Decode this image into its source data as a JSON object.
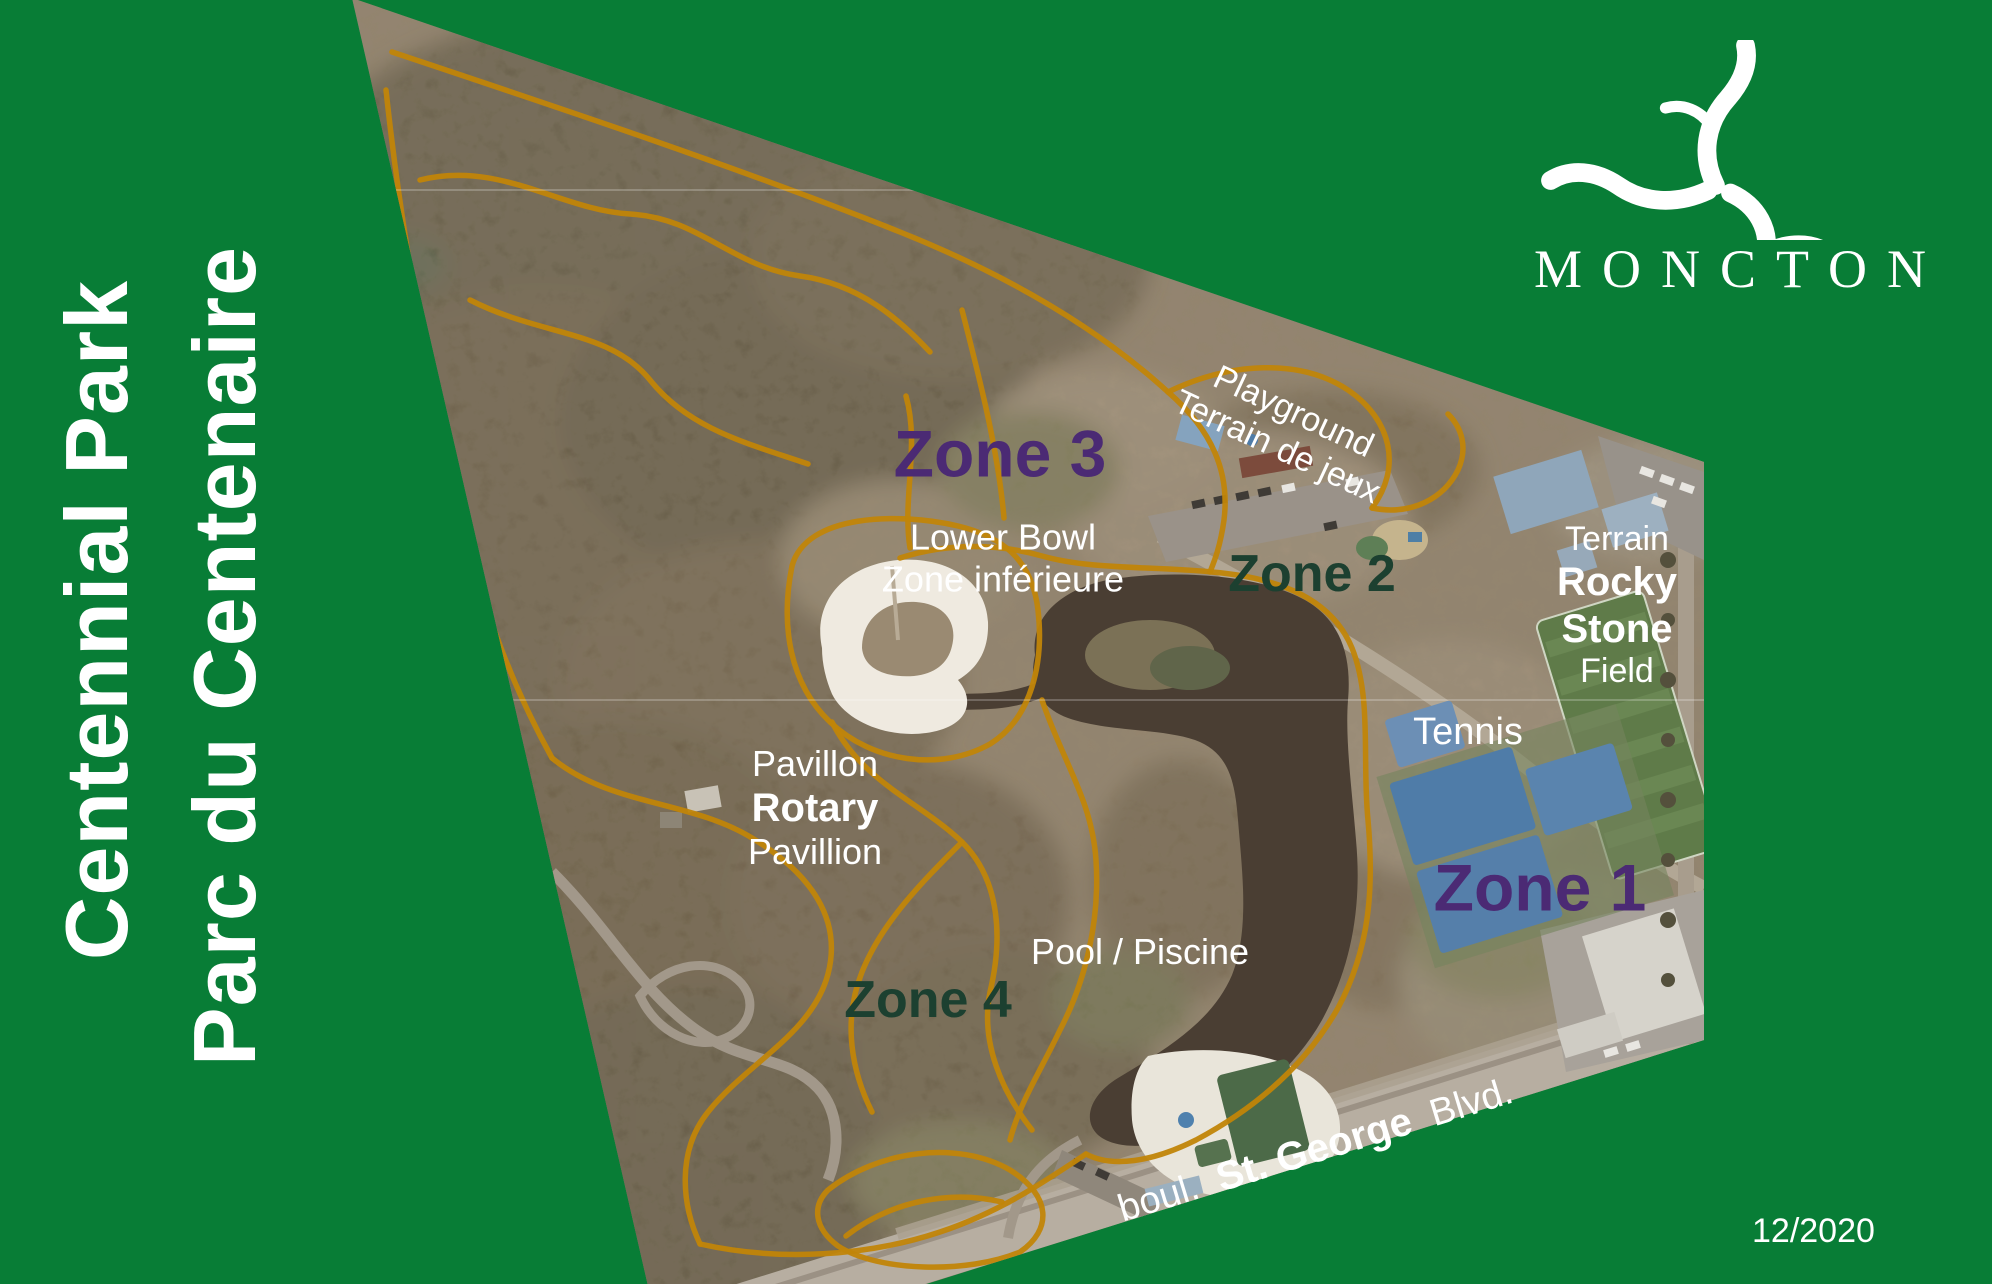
{
  "colors": {
    "green-bg": "#087D36",
    "zone-purple": "#4B2A74",
    "zone-forest": "#1C4030",
    "trail-amber": "#C18508",
    "text-white": "#FFFFFF"
  },
  "titles": {
    "english": "Centennial Park",
    "french": "Parc du Centenaire"
  },
  "logo": {
    "icon": "moncton-swirl-icon",
    "wordmark": "MONCTON"
  },
  "footer": {
    "date": "12/2020"
  },
  "map_labels": {
    "zone1": "Zone 1",
    "zone2": "Zone 2",
    "zone3": "Zone 3",
    "zone4": "Zone 4",
    "lower_bowl_en": "Lower Bowl",
    "lower_bowl_fr": "Zone inférieure",
    "playground_en": "Playground",
    "playground_fr": "Terrain de jeux",
    "rocky_prefix": "Terrain",
    "rocky_name1": "Rocky",
    "rocky_name2": "Stone",
    "rocky_suffix": "Field",
    "tennis": "Tennis",
    "pavilion_fr": "Pavillon",
    "pavilion_name": "Rotary",
    "pavilion_en": "Pavillion",
    "pool": "Pool / Piscine",
    "street_prefix": "boul.",
    "street_name": "St. George",
    "street_suffix": "Blvd."
  }
}
